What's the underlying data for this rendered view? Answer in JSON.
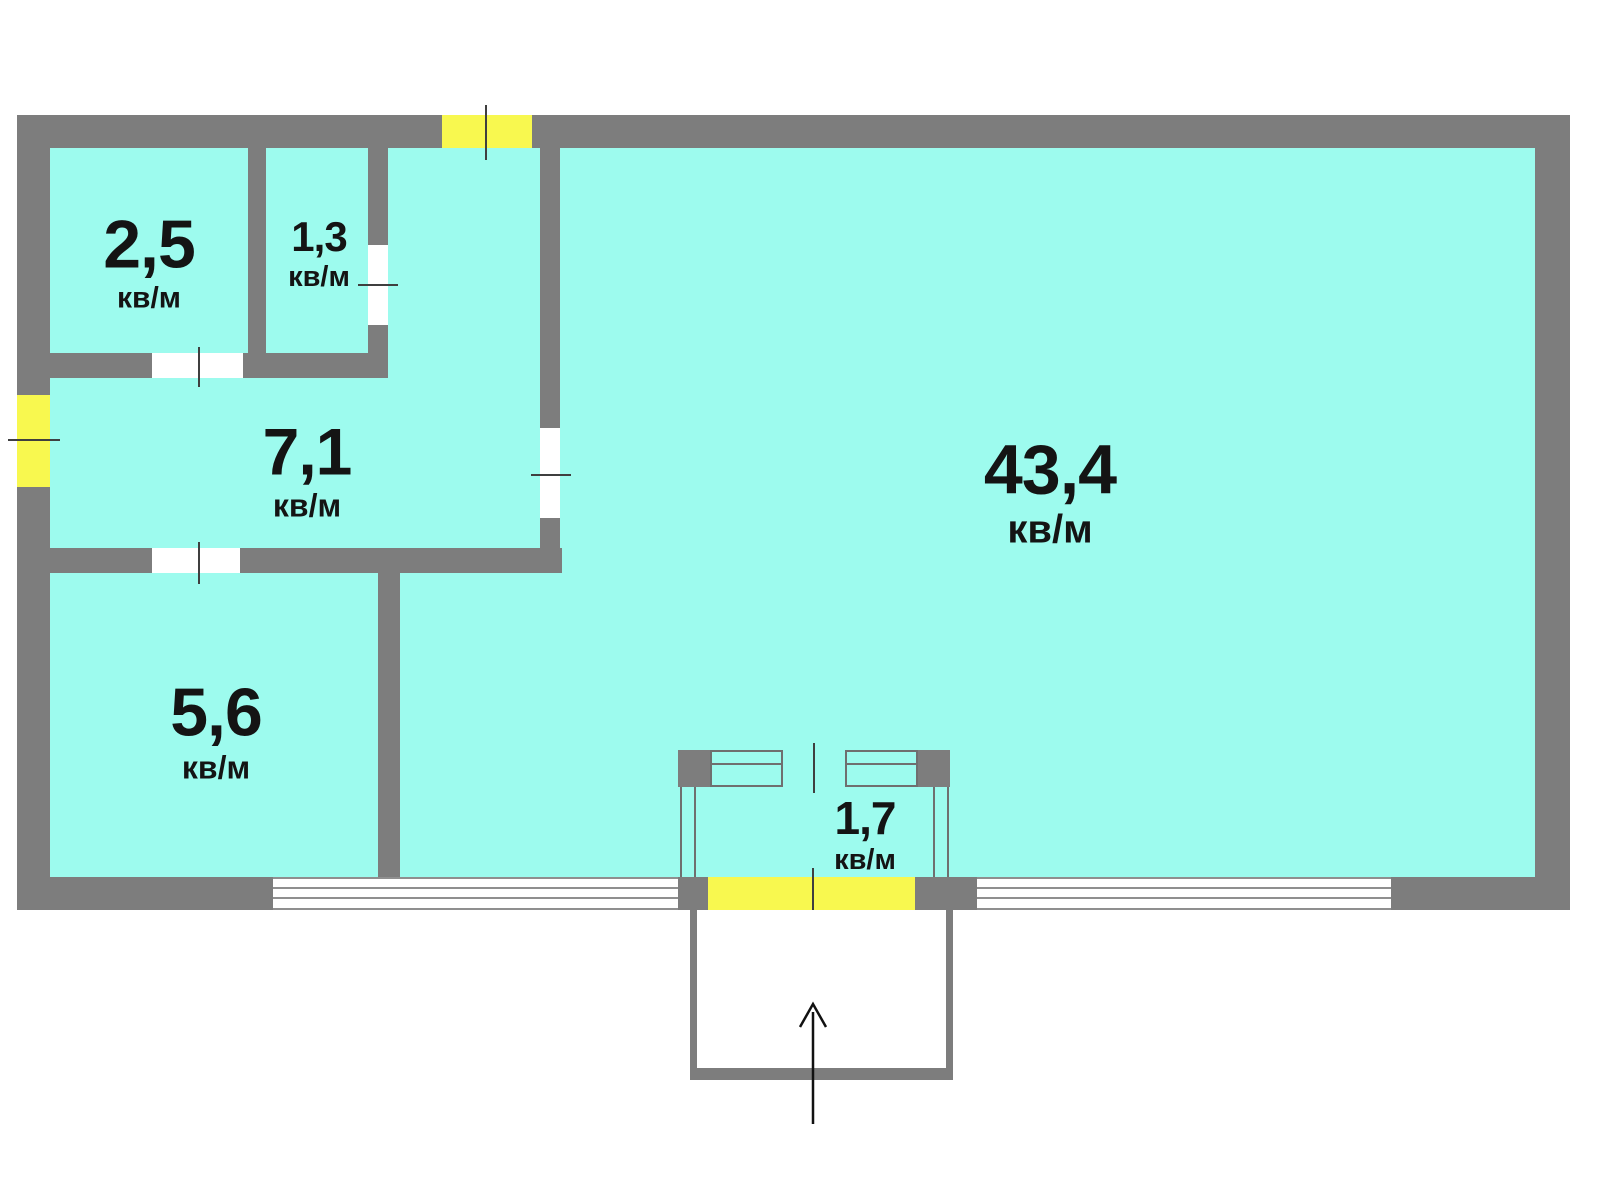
{
  "plan": {
    "unit_label": "кв/м",
    "rooms": [
      {
        "id": "storage",
        "area": "2,5"
      },
      {
        "id": "bathroom",
        "area": "1,3"
      },
      {
        "id": "hallway",
        "area": "7,1"
      },
      {
        "id": "kitchen",
        "area": "5,6"
      },
      {
        "id": "living-room",
        "area": "43,4"
      },
      {
        "id": "balcony",
        "area": "1,7"
      }
    ],
    "colors": {
      "floor": "#9dfbee",
      "wall": "#7d7d7d",
      "door-accent": "#f8f84f",
      "window": "#ffffff",
      "label-text": "#141414",
      "tick": "#3f3f3f"
    }
  }
}
